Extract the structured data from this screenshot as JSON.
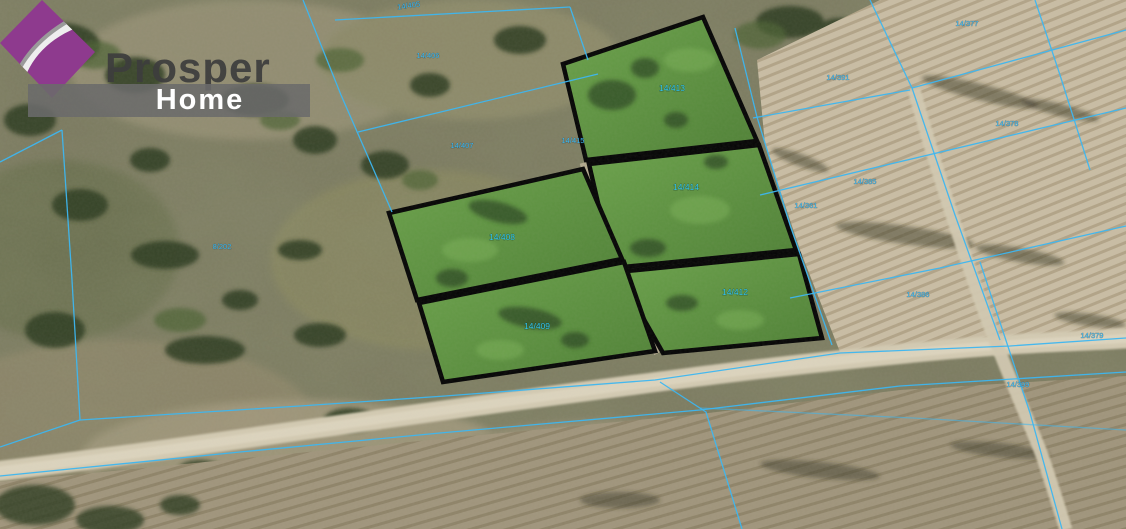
{
  "logo": {
    "brand": "Prosper",
    "sub": "Home",
    "accent_color": "#8e3a8e",
    "bar_color": "#6b6b6b"
  },
  "map": {
    "type": "aerial-cadastral-map",
    "line_color": "#3db6f0",
    "highlight_fill": "#5f9440",
    "highlight_outline": "#050505",
    "highlighted_plots": [
      "14/413",
      "14/414",
      "14/408",
      "14/409",
      "14/412"
    ],
    "labels": [
      {
        "text": "14/413",
        "x": 672,
        "y": 91,
        "kind": "plot"
      },
      {
        "text": "14/414",
        "x": 686,
        "y": 190,
        "kind": "plot"
      },
      {
        "text": "14/408",
        "x": 502,
        "y": 240,
        "kind": "plot"
      },
      {
        "text": "14/409",
        "x": 537,
        "y": 329,
        "kind": "plot"
      },
      {
        "text": "14/412",
        "x": 735,
        "y": 295,
        "kind": "plot"
      },
      {
        "text": "14/405",
        "x": 409,
        "y": 8,
        "kind": "cad",
        "rotate": -8
      },
      {
        "text": "14/406",
        "x": 428,
        "y": 58,
        "kind": "cad"
      },
      {
        "text": "14/407",
        "x": 462,
        "y": 148,
        "kind": "cad"
      },
      {
        "text": "14/415",
        "x": 573,
        "y": 143,
        "kind": "cad"
      },
      {
        "text": "8/202",
        "x": 222,
        "y": 249,
        "kind": "cad"
      },
      {
        "text": "14/391",
        "x": 838,
        "y": 80,
        "kind": "cad"
      },
      {
        "text": "14/377",
        "x": 967,
        "y": 26,
        "kind": "cad"
      },
      {
        "text": "14/378",
        "x": 1007,
        "y": 126,
        "kind": "cad"
      },
      {
        "text": "14/385",
        "x": 865,
        "y": 184,
        "kind": "cad"
      },
      {
        "text": "14/361",
        "x": 806,
        "y": 208,
        "kind": "cad"
      },
      {
        "text": "14/386",
        "x": 918,
        "y": 297,
        "kind": "cad"
      },
      {
        "text": "14/379",
        "x": 1092,
        "y": 338,
        "kind": "cad"
      },
      {
        "text": "14/399",
        "x": 1018,
        "y": 387,
        "kind": "cad"
      }
    ]
  }
}
